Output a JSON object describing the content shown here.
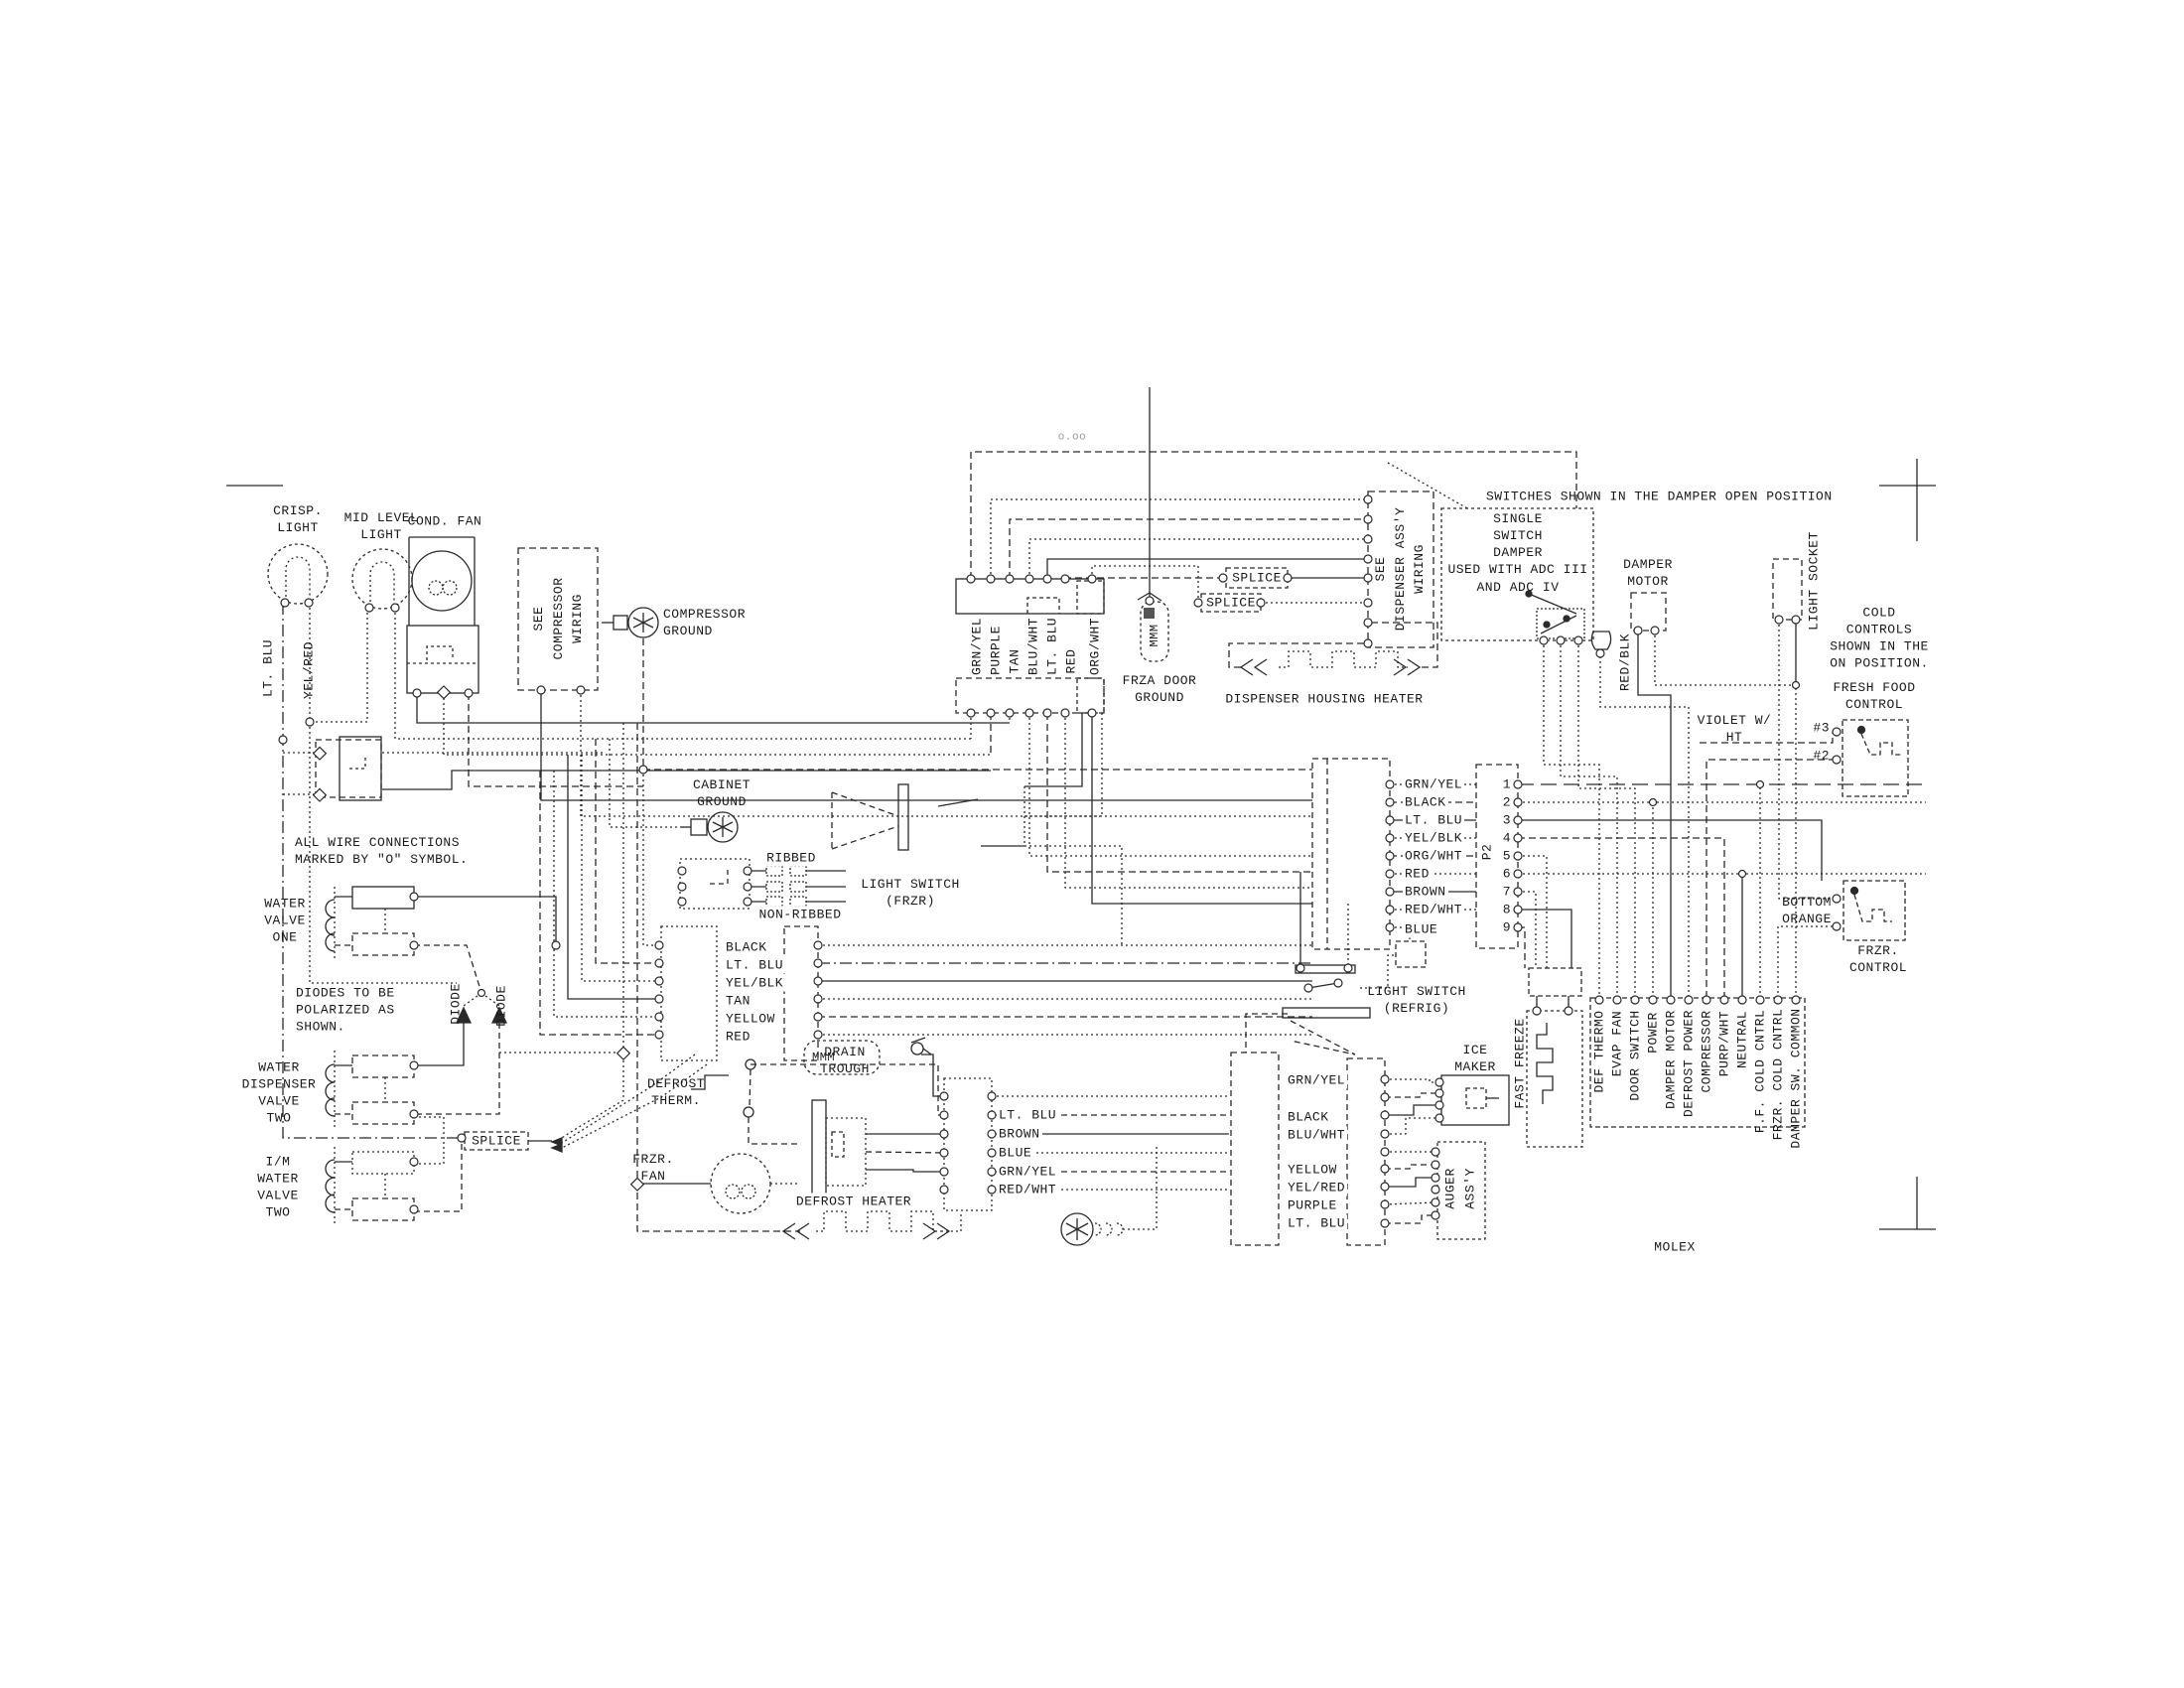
{
  "note_top": "SWITCHES SHOWN IN THE DAMPER OPEN POSITION",
  "note_faint": "o.oo",
  "notes": {
    "all_wire": "ALL WIRE CONNECTIONS\nMARKED BY \"O\" SYMBOL.",
    "diodes": "DIODES TO BE\nPOLARIZED AS\nSHOWN.",
    "cold_controls": "COLD\nCONTROLS\nSHOWN IN THE\nON POSITION.",
    "single_switch": "SINGLE\nSWITCH\nDAMPER\nUSED WITH ADC III\nAND ADC IV",
    "molex": "MOLEX"
  },
  "components": {
    "crisp_light": "CRISP.\nLIGHT",
    "mid_level_light": "MID LEVEL\nLIGHT",
    "cond_fan": "COND. FAN",
    "see_compressor_wiring": "SEE\nCOMPRESSOR\nWIRING",
    "compressor_ground": "COMPRESSOR\nGROUND",
    "cabinet_ground": "CABINET\nGROUND",
    "ribbed": "RIBBED",
    "non_ribbed": "NON-RIBBED",
    "light_switch_frzr": "LIGHT SWITCH\n(FRZR)",
    "water_valve_one": "WATER\nVALVE\nONE",
    "water_dispenser_valve_two": "WATER\nDISPENSER\nVALVE\nTWO",
    "im_water_valve_two": "I/M\nWATER\nVALVE\nTWO",
    "splice": "SPLICE",
    "defrost_therm": "DEFROST\nTHERM.",
    "drain_trough": "DRAIN\nTROUGH",
    "frzr_fan": "FRZR.\nFAN",
    "defrost_heater": "DEFROST HEATER",
    "frza_door_ground": "FRZA DOOR\nGROUND",
    "dispenser_housing_heater": "DISPENSER HOUSING HEATER",
    "see_dispenser_assy_wiring": "SEE\nDISPENSER ASS'Y\nWIRING",
    "damper_motor": "DAMPER\nMOTOR",
    "light_socket": "LIGHT SOCKET",
    "fresh_food_control": "FRESH FOOD\nCONTROL",
    "frzr_control": "FRZR.\nCONTROL",
    "bottom_orange": "BOTTOM\nORANGE",
    "violet_w_ht": "VIOLET W/\nHT",
    "light_switch_refrig": "LIGHT SWITCH\n(REFRIG)",
    "ice_maker": "ICE\nMAKER",
    "auger_assy": "AUGER\nASS'Y",
    "fast_freeze": "FAST FREEZE",
    "red_blk": "RED/BLK",
    "diode": "DIODE",
    "lt_blu_v": "LT. BLU",
    "yel_red_v": "YEL/RED",
    "pin3": "#3",
    "pin2": "#2",
    "mmm": "MMM"
  },
  "bundles": {
    "door_harness": [
      "GRN/YEL",
      "PURPLE",
      "TAN",
      "BLU/WHT",
      "LT. BLU",
      "RED",
      "ORG/WHT"
    ],
    "cabinet_harness": [
      "BLACK",
      "LT. BLU",
      "YEL/BLK",
      "TAN",
      "YELLOW",
      "RED"
    ],
    "p2_wires": [
      "GRN/YEL",
      "BLACK",
      "LT. BLU",
      "YEL/BLK",
      "ORG/WHT",
      "RED",
      "BROWN",
      "RED/WHT",
      "BLUE"
    ],
    "freezer_harness": [
      "LT. BLU",
      "BROWN",
      "BLUE",
      "GRN/YEL",
      "RED/WHT"
    ],
    "icemaker_harness": [
      "GRN/YEL",
      "BLACK",
      "BLU/WHT",
      "YELLOW",
      "YEL/RED",
      "PURPLE",
      "LT. BLU"
    ]
  },
  "connectors": {
    "p2": {
      "name": "P2",
      "pins": [
        "1",
        "2",
        "3",
        "4",
        "5",
        "6",
        "7",
        "8",
        "9"
      ]
    },
    "main_harness": [
      "DEF THERMO",
      "EVAP FAN",
      "DOOR SWITCH",
      "POWER",
      "DAMPER MOTOR",
      "DEFROST POWER",
      "COMPRESSOR",
      "PURP/WHT",
      "NEUTRAL",
      "F.F. COLD CNTRL",
      "FRZR. COLD CNTRL",
      "DAMPER SW. COMMON"
    ]
  }
}
